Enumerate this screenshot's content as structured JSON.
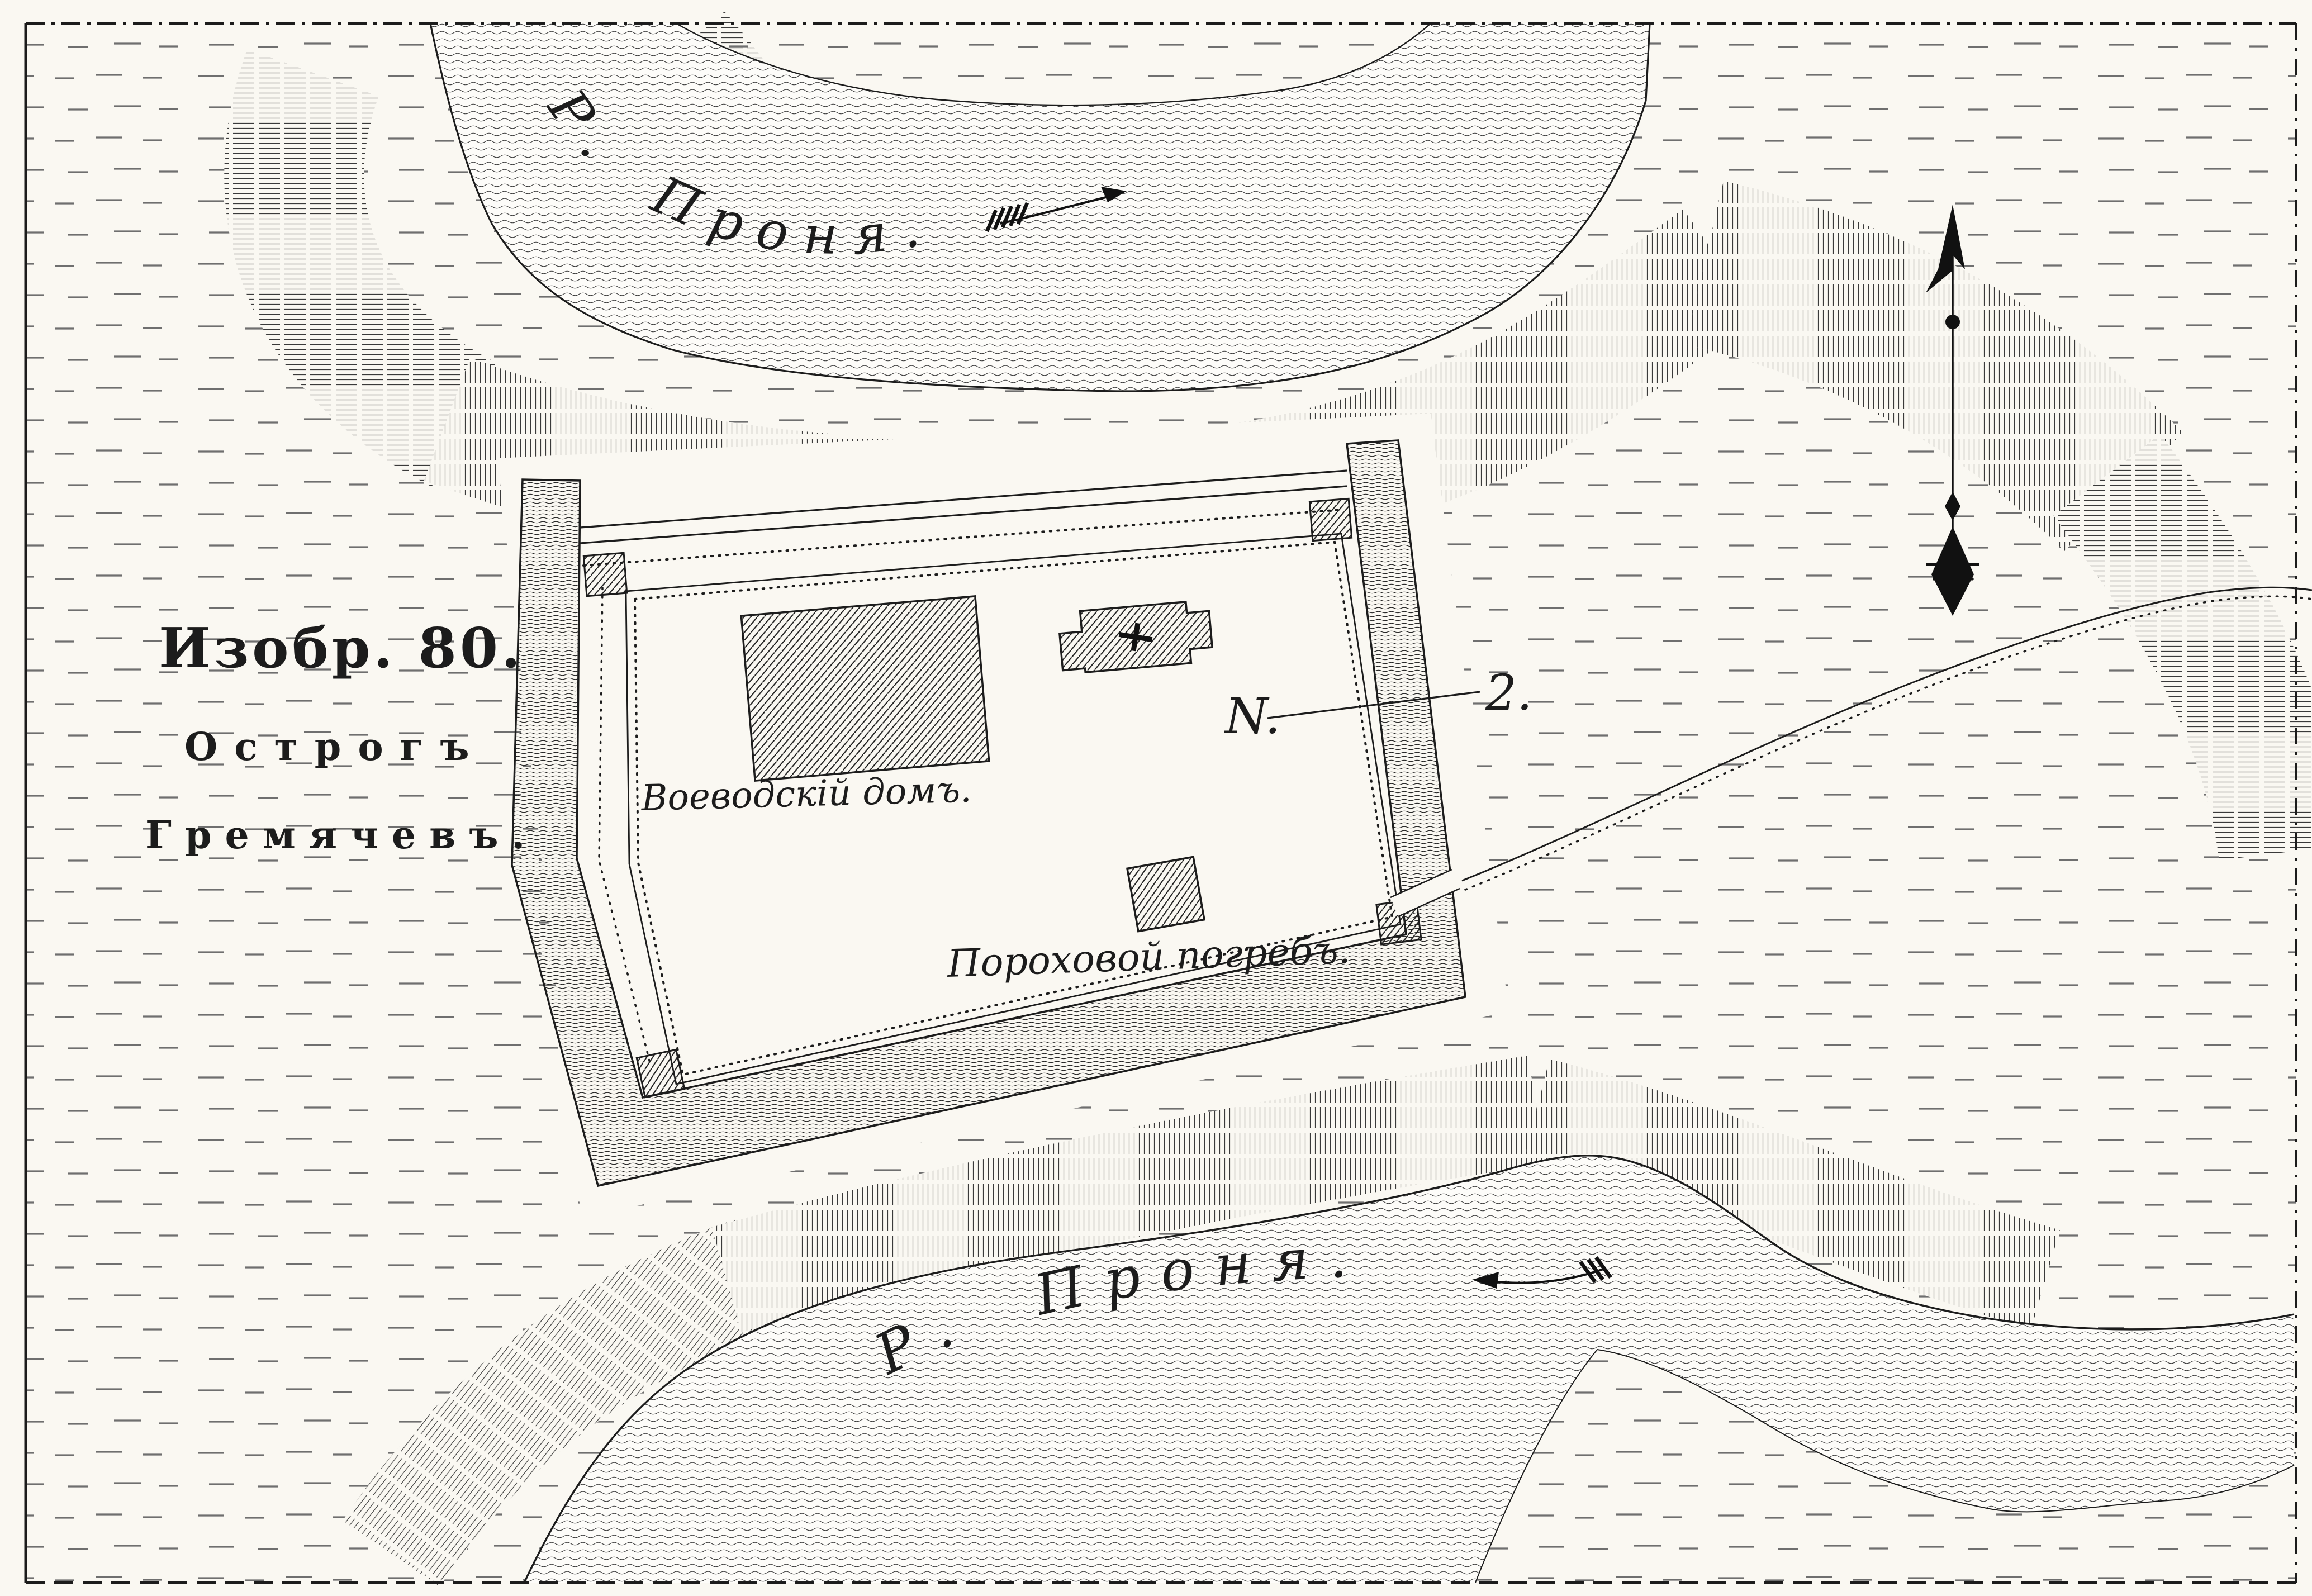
{
  "figure": {
    "number_line": "Изобр. 80.",
    "title_line1": "Острогъ",
    "title_line2": "Гремячевъ."
  },
  "rivers": {
    "top": {
      "label": "Р. Проня.",
      "flow_direction": "east"
    },
    "bottom": {
      "label": "Р. Проня.",
      "flow_direction": "west"
    }
  },
  "fort": {
    "voivode_house_label": "Воеводскій домъ.",
    "powder_cellar_label": "Пороховой погребъ.",
    "features": [
      "rampart",
      "stockade",
      "corner-towers",
      "church",
      "gate",
      "road"
    ]
  },
  "callout": {
    "letter": "N.",
    "number": "2."
  },
  "icons": {
    "compass": "north-needle-icon",
    "flow_arrow_top": "flow-arrow-east-icon",
    "flow_arrow_bottom": "flow-arrow-west-icon"
  },
  "colors": {
    "paper": "#faf8f2",
    "ink": "#1c1c1c",
    "meadow_dash": "#6f6f6f"
  }
}
